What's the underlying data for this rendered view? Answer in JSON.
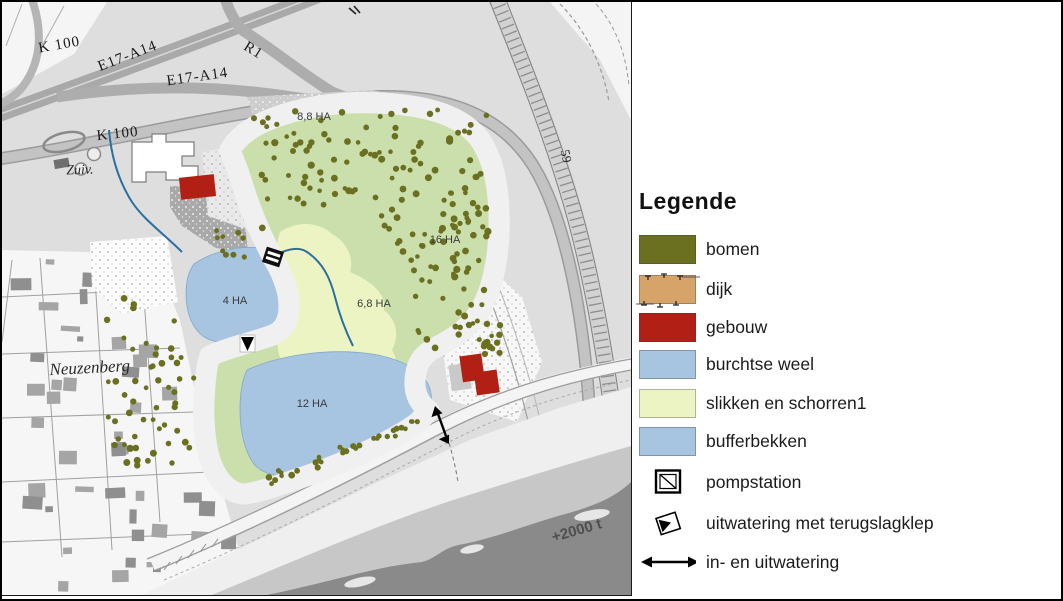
{
  "legend": {
    "title": "Legende",
    "items": [
      {
        "label": "bomen",
        "type": "swatch",
        "color": "#6B7020"
      },
      {
        "label": "dijk",
        "type": "swatch-dijk",
        "color": "#D6A469"
      },
      {
        "label": "gebouw",
        "type": "swatch",
        "color": "#B21F14"
      },
      {
        "label": "burchtse weel",
        "type": "swatch",
        "color": "#A7C5E1"
      },
      {
        "label": "slikken en schorren1",
        "type": "swatch",
        "color": "#EDF4C4"
      },
      {
        "label": "bufferbekken",
        "type": "swatch",
        "color": "#A7C5E1"
      },
      {
        "label": "pompstation",
        "type": "icon-pompstation"
      },
      {
        "label": "uitwatering met terugslagklep",
        "type": "icon-terugslagklep"
      },
      {
        "label": "in- en uitwatering",
        "type": "icon-double-arrow"
      }
    ]
  },
  "map": {
    "labels": {
      "k100_top": "K 100",
      "e17_upper": "E17-A14",
      "r1": "R1",
      "e17_lower": "E17-A14",
      "k100_mid": "K 100",
      "road59": "59",
      "zuiv": "Zuiv.",
      "neuzenberg": "Neuzenberg",
      "area_88": "8,8 HA",
      "area_16": "16 HA",
      "area_4": "4 HA",
      "area_68": "6,8 HA",
      "area_12": "12 HA",
      "river_tonnage": "+2000 t"
    },
    "colors": {
      "bomen": "#6B7020",
      "dijk": "#D6A469",
      "gebouw": "#B21F14",
      "water": "#A7C5E1",
      "slikken": "#EDF4C4",
      "groen": "#CBDFAD",
      "rivier": "#8A8A8A"
    }
  }
}
